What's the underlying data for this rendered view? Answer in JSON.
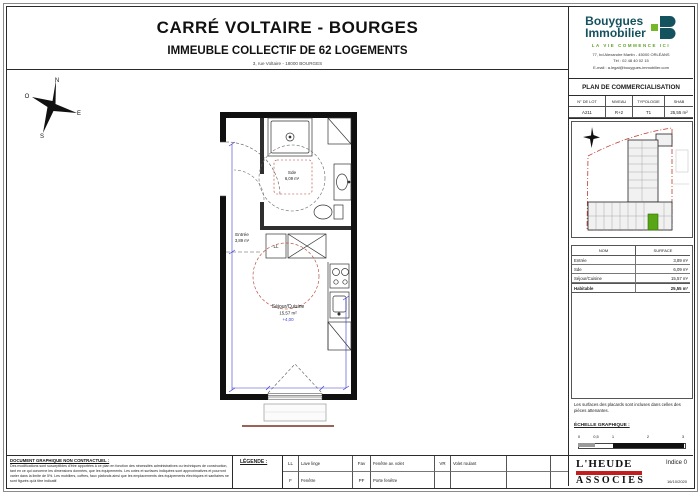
{
  "header": {
    "title": "CARRÉ VOLTAIRE - BOURGES",
    "subtitle": "IMMEUBLE COLLECTIF DE 62 LOGEMENTS",
    "address": "3, rue Voltaire - 18000 BOURGES"
  },
  "brand": {
    "name_line1": "Bouygues",
    "name_line2": "Immobilier",
    "tagline": "LA VIE COMMENCE ICI",
    "address": "77, bd Alexandre Martin - 45000 ORLÉANS",
    "phone": "Tél : 02 48 40 02 15",
    "email": "E-mail : a.legal@bouygues-immobilier.com",
    "teal": "#14535e",
    "green": "#76b82a"
  },
  "commercialisation": {
    "title": "PLAN DE COMMERCIALISATION",
    "columns": [
      "N° DE LOT",
      "NIVEAU",
      "TYPOLOGIE",
      "SHAB"
    ],
    "row": [
      "A211",
      "R+2",
      "T1",
      "25,55 m²"
    ]
  },
  "surfaces": {
    "columns": [
      "NOM",
      "SURFACE"
    ],
    "rows": [
      [
        "Entrée",
        "3,89 m²"
      ],
      [
        "Sde",
        "6,09 m²"
      ],
      [
        "Séjour/Cuisine",
        "15,57 m²"
      ],
      [
        "Habitable",
        "25,55 m²"
      ]
    ]
  },
  "plan": {
    "rooms": {
      "entree": {
        "name": "Entrée",
        "area": "3,89 m²"
      },
      "sde": {
        "name": "Sde",
        "area": "6,09 m²"
      },
      "sejour": {
        "name": "Séjour/Cuisine",
        "area": "15,57 m²",
        "level": "+4,00"
      }
    },
    "labels": {
      "ll": "LL"
    },
    "compass": {
      "n": "N",
      "e": "E",
      "s": "S",
      "o": "O"
    },
    "colors": {
      "dimension_blue": "#3a3ad0",
      "circle_red": "#b03a2a",
      "wall_black": "#101010"
    }
  },
  "sidebar_notes": {
    "line1": "Les surfaces des placards sont incluses dans celles des",
    "line2": "pièces attenantes.",
    "scale_label": "ÉCHELLE GRAPHIQUE :",
    "scale_ticks": [
      "0",
      "0,5",
      "1",
      "2",
      "3"
    ]
  },
  "revision": {
    "indice": "Indice 0",
    "date": "16/10/2020"
  },
  "architect": {
    "line1": "L'HEUDE",
    "line2": "ASSOCIES",
    "banner_color": "#c31e1e"
  },
  "footer": {
    "disclaimer_title": "DOCUMENT GRAPHIQUE NON CONTRACTUEL :",
    "d1": "Des modifications sont susceptibles d'être apportées à ce plan en fonction des nécessités administratives ou techniques de construction, tant en ce qui concerne",
    "d2": "les dimensions données, que les équipements. Les cotes et surfaces indiquées sont approximatives et pourront varier dans la limite de 5%.",
    "d3": "Les mobiliers, coffres, faux plafonds ainsi que les emplacements des équipements électriques et sanitaires ne sont figurés qu'à titre indicatif.",
    "legend_title": "LÉGENDE :",
    "legend_row1": [
      "LL",
      "Lave linge",
      "Fav",
      "Fenêtre av. volet",
      "VR",
      "Volet roulant"
    ],
    "legend_row2": [
      "F",
      "Fenêtre",
      "PF",
      "Porte fenêtre",
      "",
      ""
    ]
  }
}
